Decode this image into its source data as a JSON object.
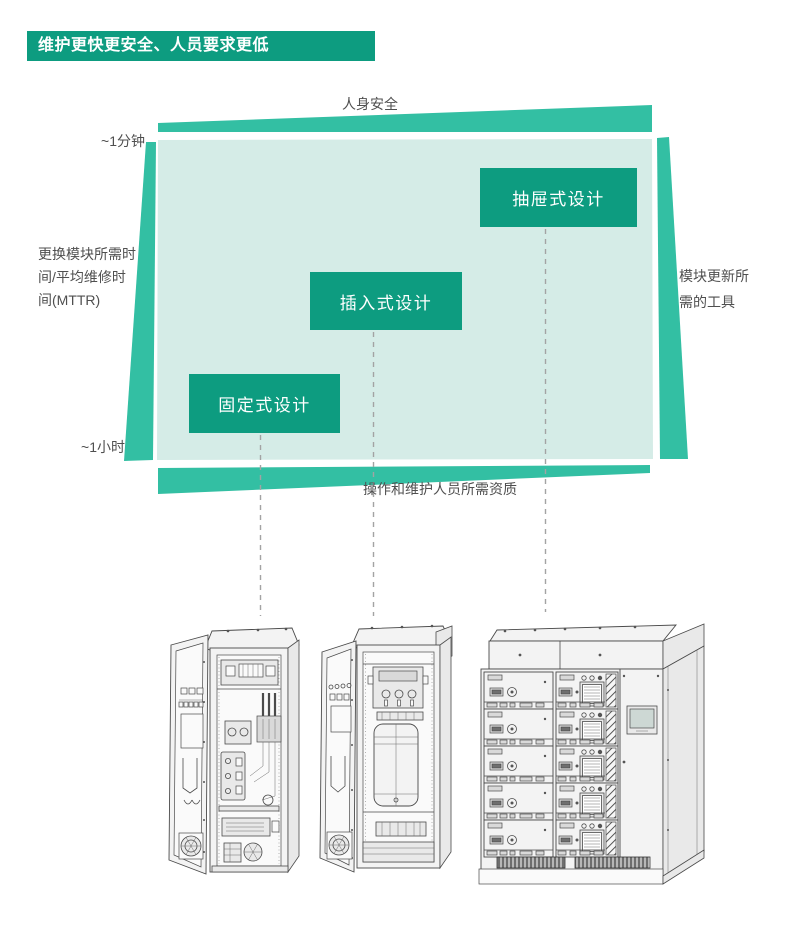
{
  "page": {
    "background": "#ffffff"
  },
  "header": {
    "title": "维护更快更安全、人员要求更低",
    "bg_color": "#0d9c80",
    "text_color": "#ffffff"
  },
  "diagram": {
    "colors": {
      "accent_dark": "#0d9c80",
      "accent_mid": "#33bfa3",
      "accent_light": "#d5ece7",
      "label_text": "#4f4f4f",
      "dash_line": "#a3a3a3"
    },
    "top_axis": {
      "label": "人身安全"
    },
    "left_axis": {
      "top_tick": "~1分钟",
      "bottom_tick": "~1小时",
      "title_lines": [
        "更换模块所需时",
        "间/平均维修时",
        "间(MTTR)"
      ]
    },
    "right_axis": {
      "title_lines": [
        "模块更新所",
        "需的工具"
      ]
    },
    "bottom_axis": {
      "label": "操作和维护人员所需资质"
    },
    "design_boxes": [
      {
        "id": "fixed",
        "label": "固定式设计"
      },
      {
        "id": "plug-in",
        "label": "插入式设计"
      },
      {
        "id": "drawer",
        "label": "抽屉式设计"
      }
    ],
    "illustrations": [
      {
        "icon": "fixed-design-cabinet"
      },
      {
        "icon": "plug-in-design-cabinet"
      },
      {
        "icon": "drawer-design-cabinet"
      }
    ]
  }
}
